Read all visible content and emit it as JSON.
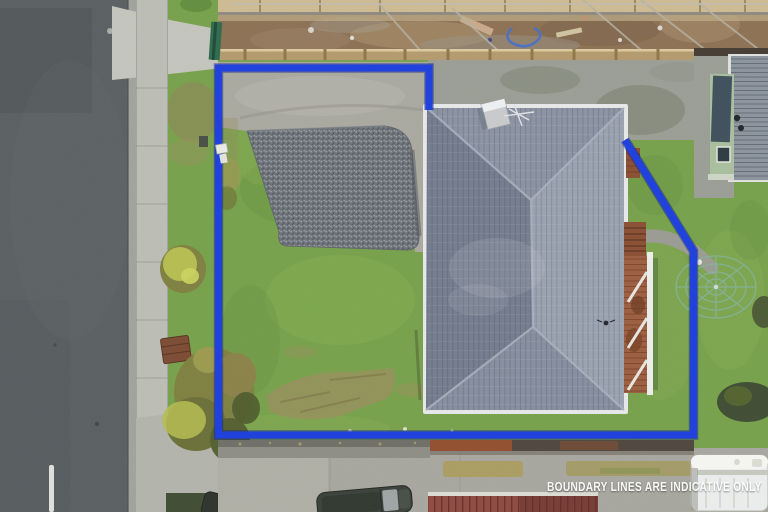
{
  "image": {
    "type": "aerial-drone-photograph",
    "subject": "residential property with hip-roof house, gravel pad, lawn and blue boundary overlay",
    "watermark": "BOUNDARY LINES ARE INDICATIVE ONLY"
  },
  "scene": {
    "elements": [
      "road",
      "footpath",
      "grass-verge",
      "construction-site",
      "driveway",
      "gravel-pad",
      "lawn",
      "main-house-hip-roof",
      "chimney",
      "tv-antenna",
      "timber-deck",
      "garden-path",
      "rotary-clothesline",
      "neighbour-house",
      "boundary-overlay",
      "concrete-wall",
      "rusty-fence",
      "red-roof-building",
      "parked-car",
      "white-van",
      "hedge",
      "picnic-table",
      "shrubs",
      "watermark"
    ]
  },
  "palette": {
    "boundary_blue": "#1c3ede",
    "boundary_blue_dark": "#0d1f86",
    "road_asphalt": "#5a5f62",
    "road_dark": "#4b5053",
    "kerb": "#9fa39b",
    "footpath": "#bcbeb5",
    "footpath_joint": "#a2a49b",
    "apron_concrete": "#c4c5bd",
    "grass": "#77a14b",
    "grass_light": "#8ab157",
    "grass_dark": "#638e3e",
    "grass_dry": "#99905c",
    "verge_dirt": "#95805c",
    "gravel": "#6e747a",
    "gravel_light": "#979da3",
    "gravel_dark": "#51575d",
    "driveway_concrete": "#aaa9a0",
    "concrete_weathered": "#9b9e95",
    "moss": "#7c8272",
    "dirt": "#8d7154",
    "dirt_light": "#a98f6b",
    "plank": "#cdbb92",
    "timber": "#b49a6e",
    "timber_dark": "#8f7748",
    "safety_fence_green": "#2f6b4e",
    "scaffold_gray": "#b7b1a4",
    "hose_blue": "#3f6ed0",
    "roof_north": "#8b93a3",
    "roof_east": "#9aa2b0",
    "roof_west": "#747d8e",
    "roof_south": "#868f9f",
    "roof_ridge": "#aab1bd",
    "gutter_white": "#e7e8ea",
    "chimney_gray": "#c9cacc",
    "deck_wood": "#9c5e40",
    "deck_dark": "#7a4227",
    "railing_white": "#eceee9",
    "step_brown": "#8a4f33",
    "wall_gray": "#8e8e86",
    "wall_top": "#6f6f67",
    "fence_rust": "#92502f",
    "fence_darkwood": "#4f463e",
    "bottom_concrete": "#a7a79f",
    "red_roof": "#8e4a42",
    "red_roof_dark": "#6d342e",
    "car_dark": "#3a413b",
    "car_glass": "#a2abab",
    "van_white": "#eceded",
    "van_gray": "#c7c8c0",
    "hedge_dark": "#3f4d33",
    "bush_yellow": "#b6bd50",
    "bush_olive": "#7f8040",
    "tree_brown": "#8a8248",
    "clothesline_green": "#85b29b",
    "neighbor_roof": "#8c949d",
    "neighbor_roof_rib": "#79828c",
    "neighbor_wall_green": "#a9bf9e",
    "neighbor_panel": "#3f505c",
    "path_gray": "#9a9c93",
    "white": "#f1f2ee",
    "watermark_white": "#ffffff"
  }
}
